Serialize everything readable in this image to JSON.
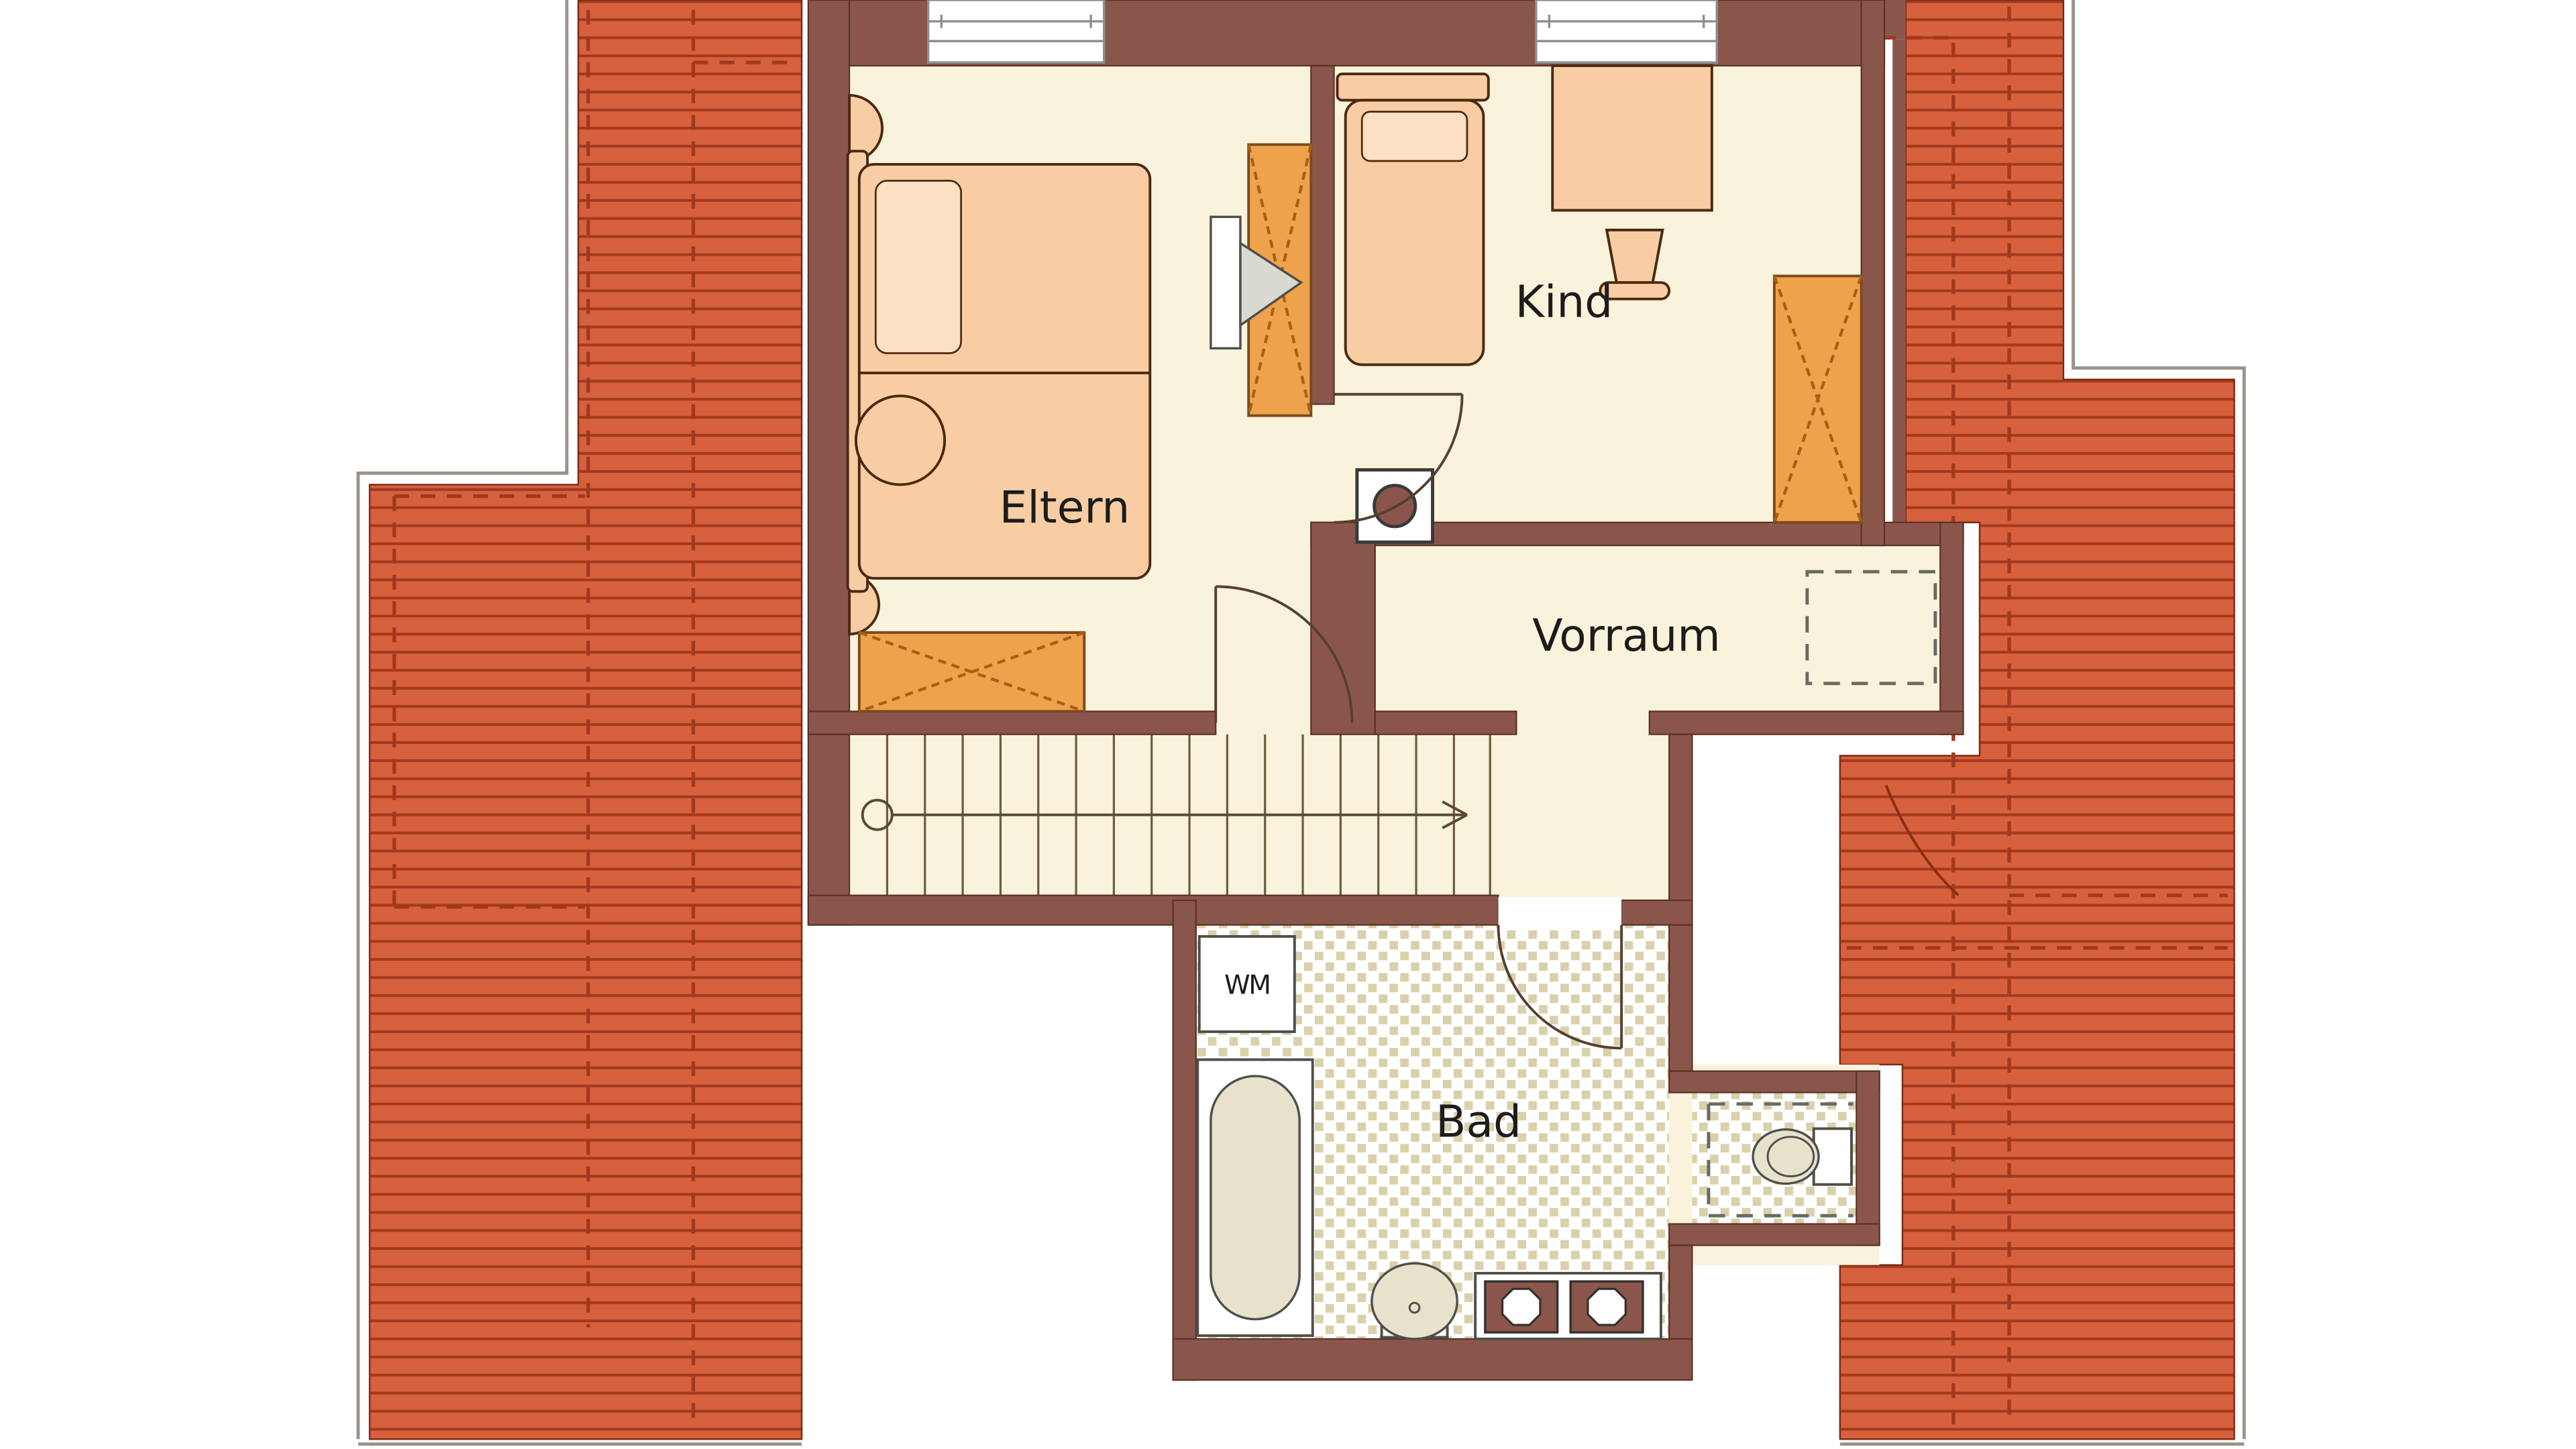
{
  "title": "Dachgeschoss Grundriss",
  "labels": {
    "eltern": "Eltern",
    "kind": "Kind",
    "vorraum": "Vorraum",
    "bad": "Bad",
    "wm": "WM"
  },
  "colors": {
    "page_bg": "#ffffff",
    "roof": "#d7603d",
    "roof_line": "#a33a1f",
    "wall": "#8a564c",
    "floor": "#f8f3da",
    "tile": "#d8d1ab",
    "furniture": "#f8cda3",
    "furniture_light": "#fbe0c4",
    "wardrobe": "#eea24c",
    "fixture_inner": "#e8e2cc",
    "text": "#1c1c1c"
  }
}
